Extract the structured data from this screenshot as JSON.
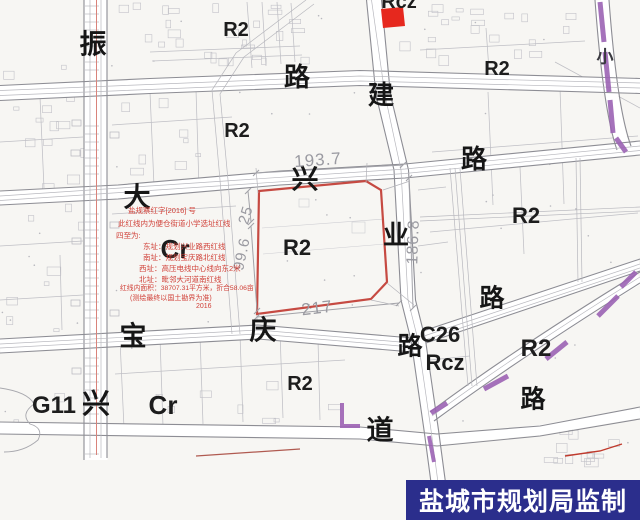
{
  "footer": {
    "text": "盐城市规划局监制",
    "bg": "#2b2e8c",
    "fg": "#ffffff"
  },
  "colors": {
    "parcel_red": "#c64a42",
    "stamp_red": "#e6281e",
    "purple": "#9c63b4",
    "annotation_red": "#d04038",
    "dim_gray": "#9a9aa1",
    "hv_line_red": "#d9837b"
  },
  "street_labels": [
    {
      "t": "振",
      "x": 93,
      "y": 45,
      "s": 27
    },
    {
      "t": "路",
      "x": 297,
      "y": 77,
      "s": 26
    },
    {
      "t": "建",
      "x": 381,
      "y": 95,
      "s": 26
    },
    {
      "t": "路",
      "x": 474,
      "y": 159,
      "s": 26
    },
    {
      "t": "大",
      "x": 137,
      "y": 198,
      "s": 27
    },
    {
      "t": "兴",
      "x": 305,
      "y": 180,
      "s": 27
    },
    {
      "t": "业",
      "x": 396,
      "y": 235,
      "s": 26
    },
    {
      "t": "宝",
      "x": 133,
      "y": 337,
      "s": 27
    },
    {
      "t": "庆",
      "x": 263,
      "y": 331,
      "s": 27
    },
    {
      "t": "路",
      "x": 410,
      "y": 347,
      "s": 25
    },
    {
      "t": "路",
      "x": 492,
      "y": 299,
      "s": 25
    },
    {
      "t": "路",
      "x": 533,
      "y": 400,
      "s": 25
    },
    {
      "t": "道",
      "x": 380,
      "y": 431,
      "s": 27
    },
    {
      "t": "兴",
      "x": 96,
      "y": 404,
      "s": 28
    },
    {
      "t": "小",
      "x": 605,
      "y": 57,
      "s": 17,
      "c": "#3a3a40"
    }
  ],
  "zone_labels": [
    {
      "t": "Rcz",
      "x": 399,
      "y": 2,
      "s": 20
    },
    {
      "t": "R2",
      "x": 236,
      "y": 30,
      "s": 20
    },
    {
      "t": "R2",
      "x": 497,
      "y": 69,
      "s": 20
    },
    {
      "t": "R2",
      "x": 237,
      "y": 131,
      "s": 20
    },
    {
      "t": "R2",
      "x": 526,
      "y": 216,
      "s": 22
    },
    {
      "t": "R2",
      "x": 297,
      "y": 248,
      "s": 22
    },
    {
      "t": "Cr",
      "x": 175,
      "y": 249,
      "s": 26
    },
    {
      "t": "R2",
      "x": 536,
      "y": 349,
      "s": 24
    },
    {
      "t": "C26",
      "x": 440,
      "y": 335,
      "s": 22
    },
    {
      "t": "Rcz",
      "x": 445,
      "y": 363,
      "s": 22
    },
    {
      "t": "G11",
      "x": 54,
      "y": 406,
      "s": 24
    },
    {
      "t": "R2",
      "x": 300,
      "y": 384,
      "s": 20
    },
    {
      "t": "Cr",
      "x": 163,
      "y": 405,
      "s": 26
    }
  ],
  "dimensions": [
    {
      "t": "193.7",
      "x": 318,
      "y": 160,
      "s": 17,
      "r": -4
    },
    {
      "t": "25",
      "x": 246,
      "y": 215,
      "s": 15,
      "r": -73
    },
    {
      "t": "99.6",
      "x": 242,
      "y": 254,
      "s": 15,
      "r": -78
    },
    {
      "t": "186.8",
      "x": 414,
      "y": 242,
      "s": 16,
      "r": -88
    },
    {
      "t": "217",
      "x": 317,
      "y": 308,
      "s": 17,
      "r": -7
    }
  ],
  "annotation": {
    "lines": [
      {
        "t": "盐规察红字[2016]  号",
        "x": 128,
        "y": 207,
        "s": 7.5
      },
      {
        "t": "此红线内为便仓街道小学选址红线",
        "x": 118,
        "y": 220,
        "s": 7.5
      },
      {
        "t": "四至为:",
        "x": 116,
        "y": 232,
        "s": 7.5
      },
      {
        "t": "东址：规划兴业路西红线",
        "x": 143,
        "y": 243,
        "s": 7.5
      },
      {
        "t": "南址：规划宝庆路北红线",
        "x": 143,
        "y": 254,
        "s": 7.5
      },
      {
        "t": "西址：高压电线中心线向东2米",
        "x": 139,
        "y": 265,
        "s": 7.5
      },
      {
        "t": "北址：毗邻大河道南红线",
        "x": 139,
        "y": 276,
        "s": 7.5
      },
      {
        "t": "红线内面积：38707.31平方米，折合58.06亩",
        "x": 120,
        "y": 286,
        "s": 6.8
      },
      {
        "t": "(测绘最终以国土勘界为准)",
        "x": 130,
        "y": 295,
        "s": 7
      },
      {
        "t": "2016",
        "x": 196,
        "y": 303,
        "s": 7
      }
    ]
  }
}
